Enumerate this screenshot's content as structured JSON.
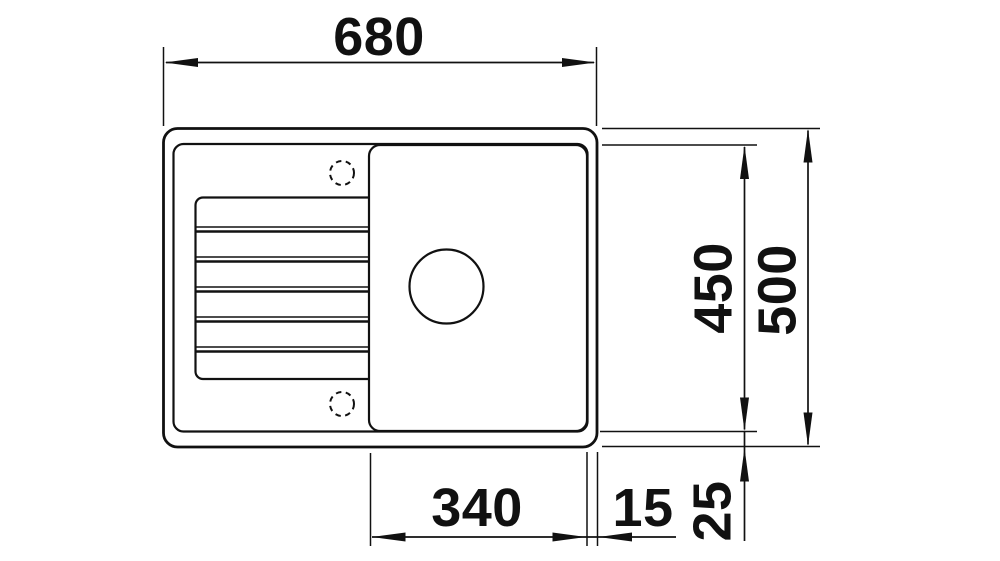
{
  "dimensions": {
    "overall_width": "680",
    "basin_field_depth": "450",
    "overall_depth": "500",
    "bowl_width": "340",
    "bowl_edge_gap": "15",
    "bowl_bottom_gap": "25"
  },
  "colors": {
    "line": "#111111",
    "background": "#ffffff"
  }
}
